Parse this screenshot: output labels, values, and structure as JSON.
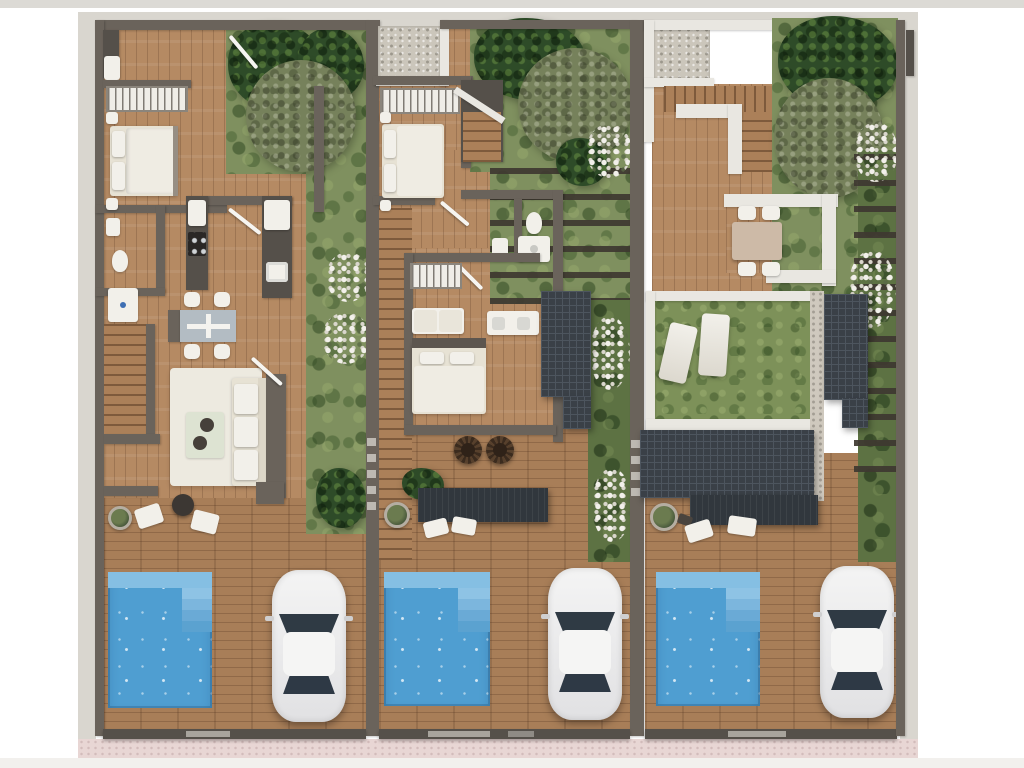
{
  "scene": {
    "kind": "architectural-floor-plan-render",
    "view": "top-down",
    "units_count": 3,
    "units": [
      {
        "id": "unit-1",
        "features": [
          "entry-hall",
          "entry-closet",
          "bathroom",
          "wardrobe-with-hangers",
          "double-bed",
          "two-nightstands",
          "kitchen-counters",
          "stove",
          "sink",
          "refrigerator",
          "staircase",
          "dining-table-with-4-chairs",
          "area-rug",
          "three-seat-sofa",
          "coffee-table",
          "garden-with-trees",
          "terrace-round-table",
          "terrace-chairs",
          "planter",
          "swimming-pool-with-steps",
          "parked-white-car",
          "driveway-gate"
        ]
      },
      {
        "id": "unit-2",
        "features": [
          "gravel-patch",
          "roof-deck",
          "bedroom-1",
          "wardrobe-with-hangers",
          "staircase",
          "bathroom-toilet-shower",
          "second-bedroom",
          "wardrobe",
          "bench-seats",
          "double-sink-vanity",
          "louvered-roof-panel",
          "two-papasan-chairs",
          "dark-canopy",
          "garden-with-pergola-slats",
          "planter",
          "floor-cushions",
          "swimming-pool-with-steps",
          "parked-white-car",
          "driveway-gate"
        ]
      },
      {
        "id": "unit-3",
        "features": [
          "gravel-patch",
          "u-shaped-staircase",
          "roof-deck",
          "outdoor-dining-table-with-4-chairs",
          "green-roof-lawn",
          "two-sun-loungers",
          "roof-panels",
          "dark-canopy",
          "planter",
          "floor-cushions",
          "garden-with-pergola-slats",
          "swimming-pool-with-steps",
          "parked-white-car",
          "driveway-gate"
        ]
      }
    ],
    "counts": {
      "pools": 3,
      "cars": 3,
      "gardens": 3,
      "gates": 3
    }
  },
  "colors": {
    "pageBg": "#ffffff",
    "topStrip": "#dcdad5",
    "frame": "#d9d6cf",
    "wall": "#6a635b",
    "wallDark": "#55504a",
    "parapet": "#e9e7e1",
    "woodFloor": "#b58a63",
    "woodDeck": "#a87e58",
    "grass": "#7f905f",
    "grassDark": "#5d7243",
    "lawn": "#7d9159",
    "treeDark": "#2e4b28",
    "treeOlive": "#76815b",
    "pool": "#4f9ed1",
    "poolLight": "#85bfe3",
    "panel": "#3a4047",
    "panelLine": "#4d555e",
    "canopy": "#31373d",
    "carBody": "#ececec",
    "carGlass": "#2f3a44",
    "gravel": "#cbc6bb",
    "sidewalk": "#e8d6d4",
    "rug": "#edeae0",
    "cream": "#e7e2d4",
    "white": "#f2f0ea",
    "mat": "#b3bcc3"
  }
}
